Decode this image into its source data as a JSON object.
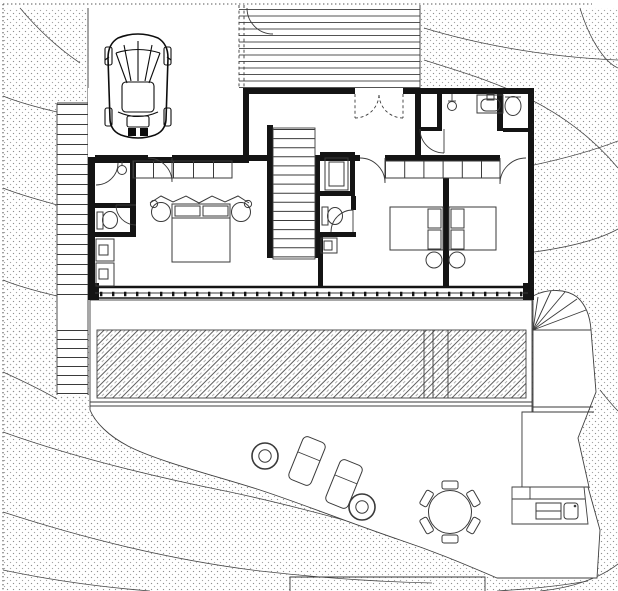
{
  "document": {
    "kind": "architectural floor plan / site plan, black ink on white",
    "visible_text": []
  },
  "colors": {
    "paper": "#ffffff",
    "ink": "#141414",
    "line": "#3a3a3a",
    "dots": "#8f8f8f",
    "hatch": "#3f3f3f"
  },
  "site": {
    "terrain": "stippled slope with contour lines on west, east and south sides",
    "boundary": "dotted property line along top and left edges"
  },
  "plan": {
    "carport": {
      "vehicle": "car (top view)",
      "surface": "open driveway"
    },
    "entry_canopy": {
      "finish": "horizontal-line hatch",
      "gate": "single swing arc"
    },
    "stairs": {
      "west_side_stair": {
        "flight1_treads": 19,
        "flight2_treads": 7
      },
      "main_stair": {
        "treads": 14
      },
      "fan_stair": {
        "treads": 6
      }
    },
    "core": {
      "elevator": "nested squares",
      "wc_center": "toilet + small basin"
    },
    "rooms": [
      "entry hall",
      "master bedroom",
      "bedroom 2",
      "bedroom 3",
      "bathroom",
      "wc",
      "west hall"
    ],
    "fixtures": [
      "shower head",
      "washbasin",
      "toilet (north-east)",
      "toilet (west)",
      "appliance 1",
      "appliance 2",
      "pendant light"
    ],
    "furniture": {
      "master_bed": {
        "pillows": 2,
        "side_tables": 2,
        "headboard": "zigzag drape"
      },
      "single_beds": 2,
      "wardrobe_master_cells": 5,
      "wardrobe_bedrooms_cells": 6
    },
    "south_facade": {
      "glazing": "continuous window band with mullion ticks"
    }
  },
  "garden": {
    "deck": {
      "finish": "45-degree hatch",
      "steps": 3
    },
    "patio_furniture": {
      "sun_loungers": 2,
      "planter_rings": 2,
      "dining_table": {
        "shape": "round",
        "chairs": 6
      },
      "outdoor_kitchen": "counter with two modules"
    },
    "lower_terrace": "white rectangular pad at bottom center",
    "path_east": "stepped walkway descending along east side"
  }
}
